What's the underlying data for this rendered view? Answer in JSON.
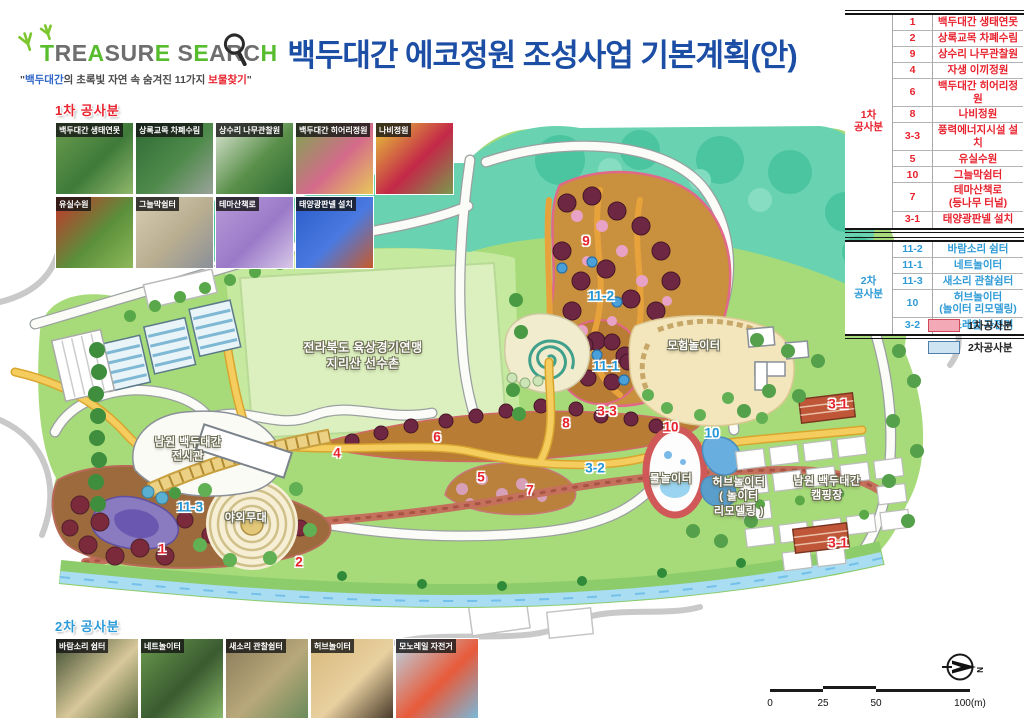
{
  "title": "백두대간 에코정원 조성사업 기본계획(안)",
  "logo": {
    "letters": [
      {
        "ch": "T",
        "color": "#58bd2e"
      },
      {
        "ch": "R",
        "color": "#6e6e6e"
      },
      {
        "ch": "E",
        "color": "#6e6e6e"
      },
      {
        "ch": "A",
        "color": "#58bd2e"
      },
      {
        "ch": "S",
        "color": "#6e6e6e"
      },
      {
        "ch": "U",
        "color": "#6e6e6e"
      },
      {
        "ch": "R",
        "color": "#6e6e6e"
      },
      {
        "ch": "E",
        "color": "#58bd2e"
      },
      {
        "ch": " ",
        "color": "#6e6e6e"
      },
      {
        "ch": "S",
        "color": "#6e6e6e"
      },
      {
        "ch": "E",
        "color": "#58bd2e"
      },
      {
        "ch": "A",
        "color": "#6e6e6e"
      },
      {
        "ch": "R",
        "color": "#6e6e6e"
      },
      {
        "ch": "C",
        "color": "#6e6e6e"
      },
      {
        "ch": "H",
        "color": "#58bd2e"
      }
    ],
    "subtitle": [
      {
        "text": "\"",
        "color": "#4a4a4a"
      },
      {
        "text": "백두대간",
        "color": "#2f66c8"
      },
      {
        "text": "의 초록빛 자연 속 숨겨진 11가지 ",
        "color": "#4a4a4a"
      },
      {
        "text": "보물찾기",
        "color": "#e8232e"
      },
      {
        "text": "\"",
        "color": "#4a4a4a"
      }
    ]
  },
  "tables": [
    {
      "group": "1차\n공사분",
      "color": "#e8232e",
      "rows": [
        [
          "1",
          "백두대간 생태연못"
        ],
        [
          "2",
          "상록교목 차폐수림"
        ],
        [
          "9",
          "상수리 나무관찰원"
        ],
        [
          "4",
          "자생 이끼정원"
        ],
        [
          "6",
          "백두대간 히어리정원"
        ],
        [
          "8",
          "나비정원"
        ],
        [
          "3-3",
          "풍력에너지시설 설치"
        ],
        [
          "5",
          "유실수원"
        ],
        [
          "10",
          "그늘막쉼터"
        ],
        [
          "7",
          "테마산책로\n(등나무 터널)"
        ],
        [
          "3-1",
          "태양광판넬 설치"
        ]
      ]
    },
    {
      "group": "2차\n공사분",
      "color": "#2e9bd6",
      "rows": [
        [
          "11-2",
          "바람소리 쉼터"
        ],
        [
          "11-1",
          "네트놀이터"
        ],
        [
          "11-3",
          "새소리 관찰쉼터"
        ],
        [
          "10",
          "허브놀이터\n(놀이터 리모델링)"
        ],
        [
          "3-2",
          "모노레일 자전거"
        ]
      ]
    }
  ],
  "legend": [
    {
      "label": "1차공사분",
      "fill": "#f3a9b6",
      "border": "#cf4b5c"
    },
    {
      "label": "2차공사분",
      "fill": "#cfe4f3",
      "border": "#4d7fa8"
    }
  ],
  "photos": {
    "top": {
      "header": "1차 공사분",
      "rows": [
        [
          {
            "label": "백두대간 생태연못",
            "colors": [
              "#6a9c4e",
              "#3f7a3a",
              "#8fb86a"
            ]
          },
          {
            "label": "상록교목 차폐수림",
            "colors": [
              "#2f6b35",
              "#4e8a4a",
              "#9aa39a"
            ]
          },
          {
            "label": "상수리 나무관찰원",
            "colors": [
              "#dfe8d8",
              "#5a8f4a",
              "#2f6b35"
            ]
          },
          {
            "label": "백두대간 히어리정원",
            "colors": [
              "#7aa84e",
              "#d46a8a",
              "#e8c85a"
            ]
          },
          {
            "label": "나비정원",
            "colors": [
              "#e8c83a",
              "#c42848",
              "#7a9a4e"
            ]
          }
        ],
        [
          {
            "label": "유실수원",
            "colors": [
              "#c8342c",
              "#5a8f3a",
              "#8fb85a"
            ]
          },
          {
            "label": "그늘막쉼터",
            "colors": [
              "#d8cdb0",
              "#b8ad90",
              "#8a9098"
            ]
          },
          {
            "label": "테마산책로",
            "colors": [
              "#b89ad8",
              "#9a7ac8",
              "#d8c8e8"
            ]
          },
          {
            "label": "태양광판넬 설치",
            "colors": [
              "#2a5ac8",
              "#4a7ae0",
              "#c85a2a"
            ]
          }
        ]
      ]
    },
    "bottom": {
      "header": "2차 공사분",
      "rows": [
        [
          {
            "label": "바람소리 쉼터",
            "colors": [
              "#3a4a2e",
              "#d8c89a",
              "#5a6a3e"
            ]
          },
          {
            "label": "네트놀이터",
            "colors": [
              "#6a9a4e",
              "#3a5a30",
              "#8ab86a"
            ]
          },
          {
            "label": "새소리 관찰쉼터",
            "colors": [
              "#8a7a5a",
              "#b8a87a",
              "#6a8a5a"
            ]
          },
          {
            "label": "허브놀이터",
            "colors": [
              "#d8b87a",
              "#e8d0a0",
              "#4a3a2a"
            ]
          },
          {
            "label": "모노레일 자전거",
            "colors": [
              "#b8d8e8",
              "#e85a3a",
              "#7ab8d8"
            ]
          }
        ]
      ]
    }
  },
  "map": {
    "labels": [
      {
        "text": "전라북도 육상경기연맹\n지리산 선수촌",
        "x": 363,
        "y": 356,
        "size": 12
      },
      {
        "text": "남원 백두대간\n전시관",
        "x": 188,
        "y": 450,
        "size": 11
      },
      {
        "text": "야외무대",
        "x": 246,
        "y": 518,
        "size": 11
      },
      {
        "text": "모험놀이터",
        "x": 694,
        "y": 346,
        "size": 11
      },
      {
        "text": "물놀이터",
        "x": 671,
        "y": 479,
        "size": 11
      },
      {
        "text": "허브놀이터\n( 놀이터\n리모델링 )",
        "x": 739,
        "y": 497,
        "size": 11
      },
      {
        "text": "남원 백두대간\n캠핑장",
        "x": 827,
        "y": 489,
        "size": 11
      }
    ],
    "markers": [
      {
        "text": "9",
        "x": 586,
        "y": 241,
        "phase": 1
      },
      {
        "text": "11-2",
        "x": 601,
        "y": 296,
        "phase": 2
      },
      {
        "text": "11-1",
        "x": 606,
        "y": 366,
        "phase": 2
      },
      {
        "text": "3-3",
        "x": 607,
        "y": 411,
        "phase": 1
      },
      {
        "text": "8",
        "x": 566,
        "y": 423,
        "phase": 1
      },
      {
        "text": "6",
        "x": 437,
        "y": 437,
        "phase": 1
      },
      {
        "text": "4",
        "x": 337,
        "y": 453,
        "phase": 1
      },
      {
        "text": "5",
        "x": 481,
        "y": 477,
        "phase": 1
      },
      {
        "text": "7",
        "x": 530,
        "y": 490,
        "phase": 1
      },
      {
        "text": "3-2",
        "x": 595,
        "y": 468,
        "phase": 2
      },
      {
        "text": "10",
        "x": 671,
        "y": 427,
        "phase": 1
      },
      {
        "text": "10",
        "x": 712,
        "y": 433,
        "phase": 2
      },
      {
        "text": "11-3",
        "x": 190,
        "y": 507,
        "phase": 2
      },
      {
        "text": "1",
        "x": 162,
        "y": 549,
        "phase": 1
      },
      {
        "text": "2",
        "x": 299,
        "y": 562,
        "phase": 1
      },
      {
        "text": "3-1",
        "x": 838,
        "y": 404,
        "phase": 1
      },
      {
        "text": "3-1",
        "x": 838,
        "y": 543,
        "phase": 1
      }
    ]
  },
  "scalebar": {
    "labels": [
      "0",
      "25",
      "50",
      "100(m)"
    ]
  },
  "compass": {
    "n": "N"
  },
  "colors": {
    "phase1": "#e8232e",
    "phase2": "#2e9bd6",
    "title_blue": "#1b4ea4",
    "logo_green": "#58bd2e"
  }
}
